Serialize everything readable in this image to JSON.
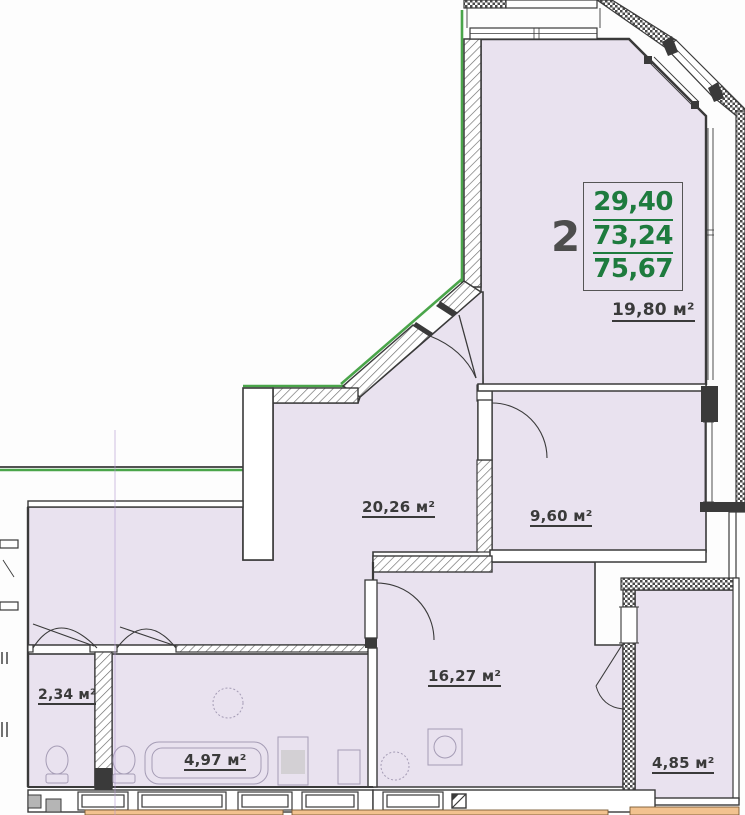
{
  "plan_title": "2-room apartment floor plan",
  "legend": {
    "rooms_count": "2",
    "values": [
      "29,40",
      "73,24",
      "75,67"
    ]
  },
  "rooms": [
    {
      "id": "living-room",
      "area_label": "19,80 м²"
    },
    {
      "id": "hall",
      "area_label": "20,26 м²"
    },
    {
      "id": "bedroom",
      "area_label": "9,60 м²"
    },
    {
      "id": "kitchen",
      "area_label": "16,27 м²"
    },
    {
      "id": "wc",
      "area_label": "2,34 м²"
    },
    {
      "id": "bathroom",
      "area_label": "4,97 м²"
    },
    {
      "id": "storage",
      "area_label": "4,85 м²"
    }
  ],
  "symbols": {
    "vent_shaft_icon": "square-with-diagonal"
  },
  "colors": {
    "room_fill": "#e9e2ef",
    "wall_line": "#3a3a3a",
    "green_accent": "#4aa54a",
    "legend_green": "#1e7b3e",
    "balcony_floor_orange": "#f2c28f",
    "scan_artifact": "#b49ad2"
  }
}
